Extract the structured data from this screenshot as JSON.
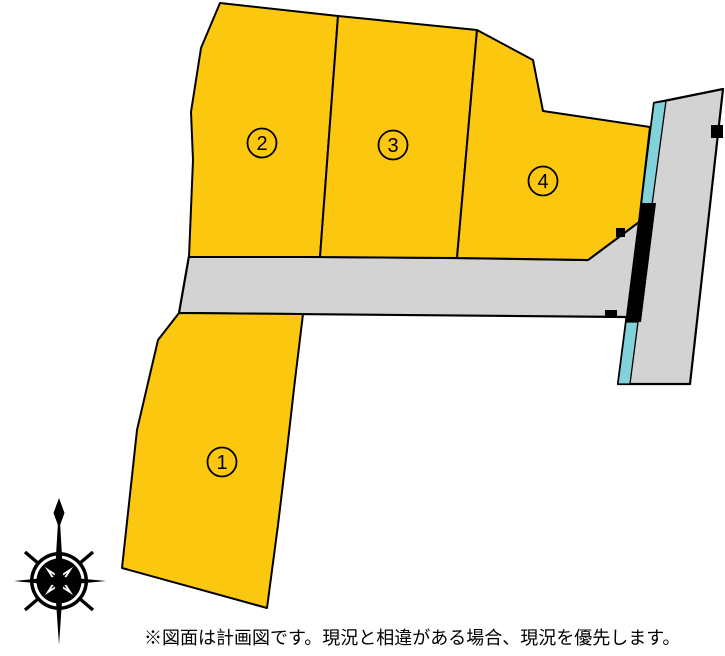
{
  "plan": {
    "plots": [
      {
        "number": "1"
      },
      {
        "number": "2"
      },
      {
        "number": "3"
      },
      {
        "number": "4"
      }
    ],
    "disclaimer": "※図面は計画図です。現況と相違がある場合、現況を優先します。",
    "colors": {
      "plot_fill": "#FCC70F",
      "road_fill": "#D3D3D3",
      "waterway_fill": "#82D2DB",
      "barrier_fill": "#000000",
      "outline": "#000000"
    }
  }
}
